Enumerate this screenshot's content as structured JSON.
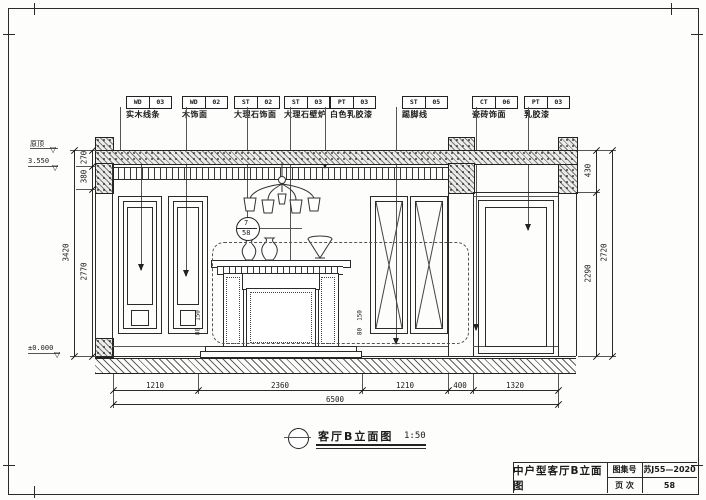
{
  "tags": [
    {
      "code": "WD",
      "num": "03",
      "desc": "实木线条"
    },
    {
      "code": "WD",
      "num": "02",
      "desc": "木饰面"
    },
    {
      "code": "ST",
      "num": "02",
      "desc": "大理石饰面"
    },
    {
      "code": "ST",
      "num": "03",
      "desc": "大理石壁炉"
    },
    {
      "code": "PT",
      "num": "03",
      "desc": "白色乳胶漆"
    },
    {
      "code": "ST",
      "num": "05",
      "desc": "踢脚线"
    },
    {
      "code": "CT",
      "num": "06",
      "desc": "瓷砖饰面"
    },
    {
      "code": "PT",
      "num": "03",
      "desc": "乳胶漆"
    }
  ],
  "levels": {
    "roof": "原顶",
    "ceiling": "3.550",
    "floor": "±0.000"
  },
  "dims": {
    "bottom": [
      "1210",
      "2360",
      "1210",
      "400",
      "1320"
    ],
    "bottom_total": "6500",
    "left": [
      "270",
      "380",
      "2770"
    ],
    "left_total": "3420",
    "right": [
      "430",
      "2290"
    ],
    "right_total": "2720",
    "panel_small": [
      "150",
      "80"
    ]
  },
  "detail_marker": {
    "top": "7",
    "bottom": "58"
  },
  "caption": {
    "name": "客厅B立面图",
    "scale": "1:50"
  },
  "titleblock": {
    "title": "中户型客厅B立面图",
    "atlas_label": "图集号",
    "atlas_value": "苏J55—2020",
    "page_label": "页 次",
    "page_value": "58"
  },
  "icons": {
    "level_triangle": "▽"
  }
}
